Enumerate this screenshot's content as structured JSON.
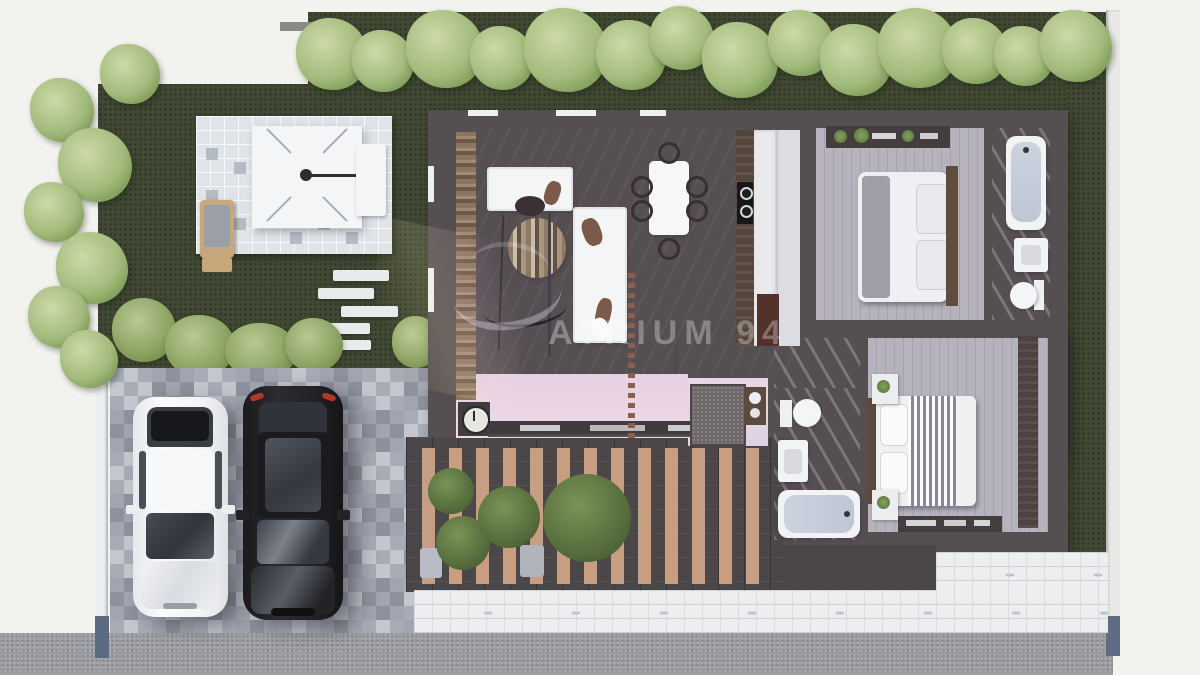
{
  "watermark": {
    "text": "ATRIUM 94"
  },
  "scene": {
    "type": "3d-floor-plan-top-view-render",
    "rooms": [
      "garden",
      "patio",
      "driveway",
      "living-room",
      "dining-area",
      "kitchen",
      "bedroom-1",
      "bathroom-1",
      "hallway",
      "bathroom-2",
      "bedroom-2",
      "deck-pergola",
      "walkway",
      "road"
    ],
    "objects": {
      "cars": [
        "white-sedan",
        "black-sedan"
      ],
      "living_room": [
        "sofa",
        "chaise-sofa",
        "round-wood-rug",
        "arc-floor-lamp",
        "tv-console",
        "wall-clock",
        "media-wall",
        "slat-divider"
      ],
      "dining": [
        "white-table",
        "six-black-chairs"
      ],
      "kitchen": [
        "wood-counter",
        "cooktop-two-burners",
        "island",
        "fridge"
      ],
      "bedroom_1": [
        "double-bed",
        "brown-headboard",
        "gray-throw",
        "pillows",
        "plant-shelf"
      ],
      "bathroom_1": [
        "bathtub",
        "sink",
        "toilet"
      ],
      "bedroom_2": [
        "double-bed",
        "striped-throw",
        "two-nightstands",
        "wardrobe",
        "decor-shelf"
      ],
      "bathroom_2": [
        "toilet",
        "sink",
        "bathtub"
      ],
      "hallway": [
        "doormat",
        "console-cabinet"
      ],
      "outdoor": [
        "parasol-canopy",
        "bench",
        "lounge-chair",
        "side-table",
        "stepping-stones",
        "hedge-trees",
        "pale-bushes",
        "deck-plants",
        "planter-pots",
        "fence",
        "fence-posts"
      ]
    },
    "counts": {
      "deck_slats": 13,
      "dining_chairs": 6,
      "cars": 2,
      "stepping_stones": 5,
      "bedrooms": 2,
      "bathrooms": 2
    },
    "colors": {
      "background": "#f2f2ee",
      "grass": "#414833",
      "tree_light": "#cddaa8",
      "wall": "#564f52",
      "marble": "#eae5ee",
      "pink_floor": "#eed7e6",
      "plank_floor": "#aeabb7",
      "bath_floor": "#c8c5d2",
      "deck_slat": "#c79e82",
      "paver_light": "#c4c7ce",
      "paver_dark": "#a7acb6",
      "road": "#9b9ca2",
      "car_white": "#f4f4f6",
      "car_black": "#232226",
      "fence_post_blue": "#5b6a80",
      "wood_counter": "#53443c",
      "headboard_wood": "#5f4c3c"
    }
  }
}
